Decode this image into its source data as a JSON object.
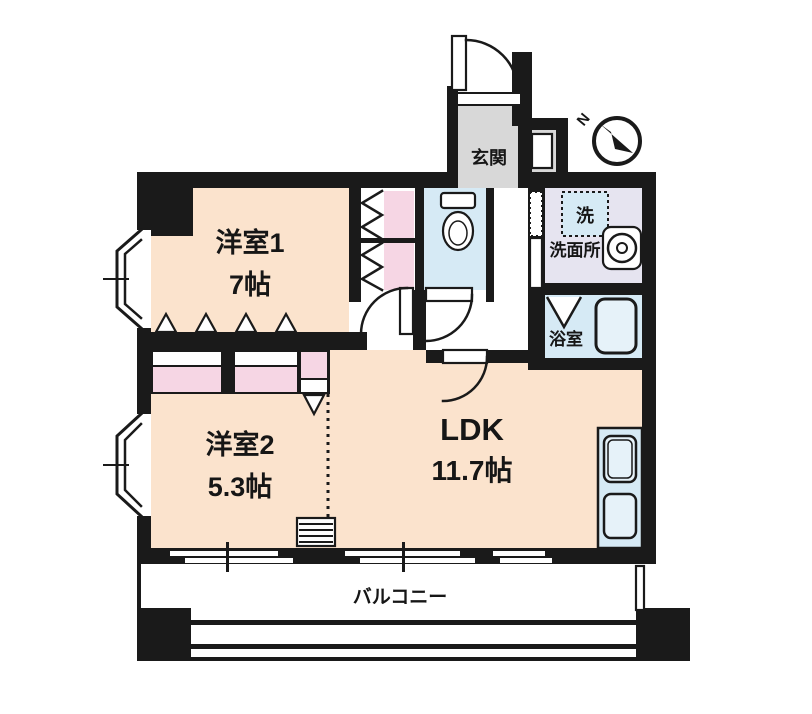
{
  "plan": {
    "rooms": {
      "room1": {
        "name": "洋室1",
        "size": "7帖"
      },
      "room2": {
        "name": "洋室2",
        "size": "5.3帖"
      },
      "ldk": {
        "name": "LDK",
        "size": "11.7帖"
      },
      "entrance": {
        "name": "玄関"
      },
      "washroom": {
        "name": "洗面所"
      },
      "washer": {
        "name": "洗"
      },
      "bathroom": {
        "name": "浴室"
      },
      "balcony": {
        "name": "バルコニー"
      }
    },
    "compass": {
      "north_label": "N"
    },
    "colors": {
      "wall": "#1a1a1a",
      "room_floor": "#fbe3cd",
      "closet_pink": "#f6d6e4",
      "water_blue": "#d6eaf5",
      "water_blue_light": "#e6f2f9",
      "washroom_lavender": "#e6e4f0",
      "entrance_gray": "#d8d8d8"
    }
  }
}
